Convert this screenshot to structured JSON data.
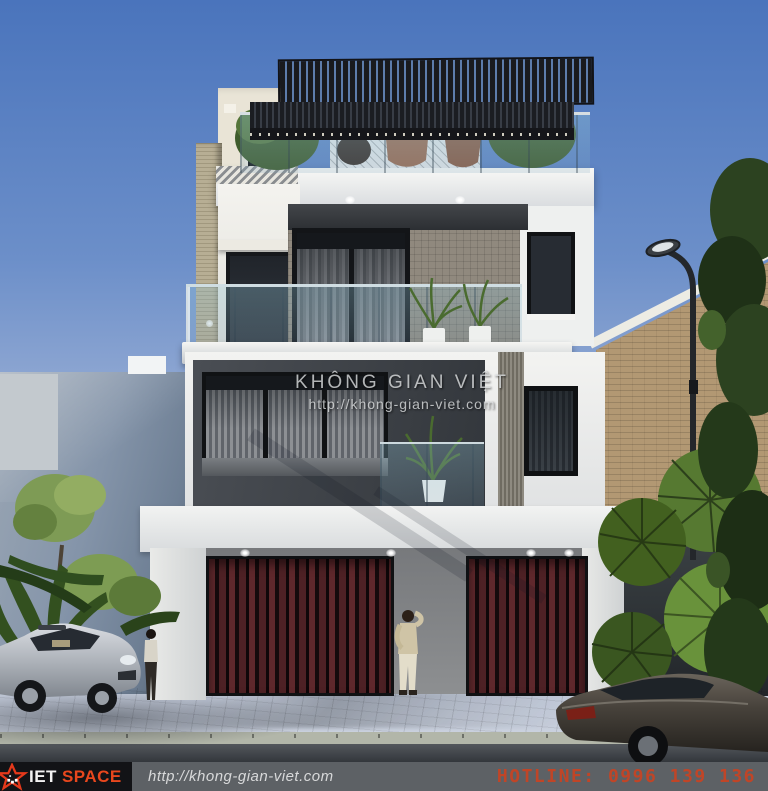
{
  "watermark": {
    "title": "KHÔNG GIAN VIỆT",
    "url": "http://khong-gian-viet.com"
  },
  "footer": {
    "brand_prefix": "IET",
    "brand_suffix": "SPACE",
    "url": "http://khong-gian-viet.com",
    "hotline": "HOTLINE: 0996 139 136"
  },
  "colors": {
    "sky_top": "#4a74bc",
    "sky_horizon": "#cdd3de",
    "brand_orange": "#e8471d",
    "hotline_red": "#c04527",
    "footer_bar": "#5d6165",
    "logo_box": "#121316",
    "garage_slats": "#5f282c",
    "pergola_slats": "#17181b",
    "stone_wall": "#90897e",
    "tower_beige": "#b7ae94",
    "brick_wall": "#b29873"
  }
}
